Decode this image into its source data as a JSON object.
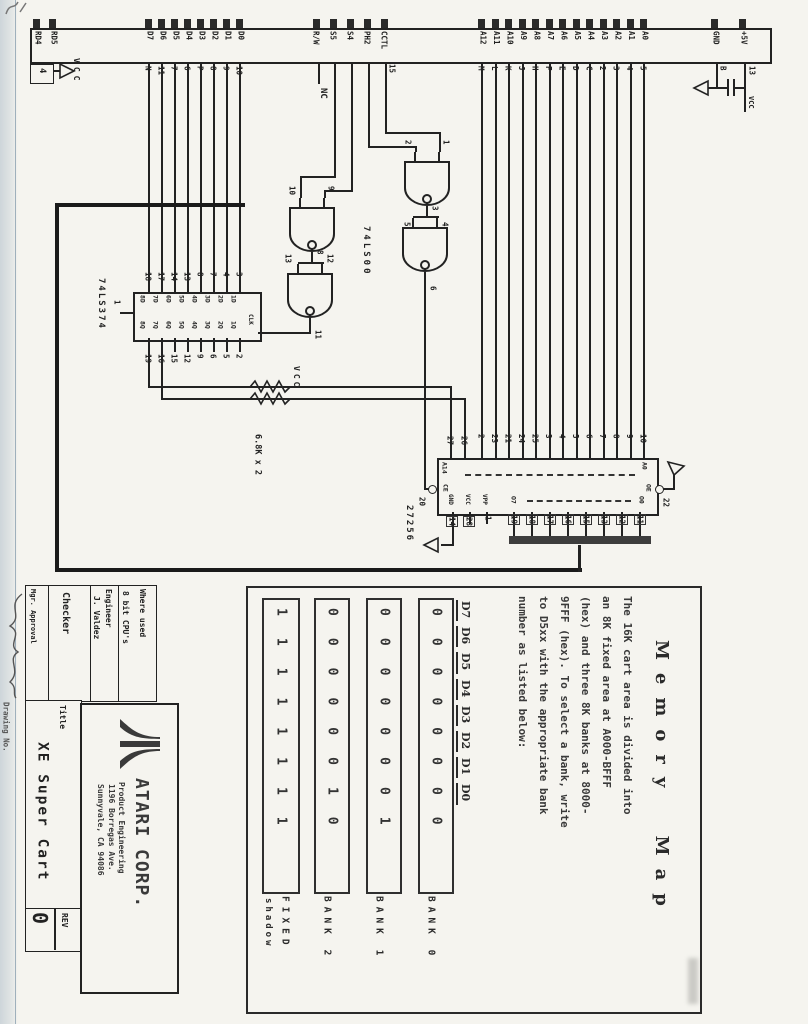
{
  "connector": {
    "rd_pins": [
      "RD4",
      "RD5"
    ],
    "data_pins": [
      "D7",
      "D6",
      "D5",
      "D4",
      "D3",
      "D2",
      "D1",
      "D0"
    ],
    "data_wire_pins": [
      "N",
      "11",
      "7",
      "6",
      "P",
      "8",
      "9",
      "10"
    ],
    "ctl_pins": [
      "R/W",
      "S5",
      "S4",
      "PH2",
      "CCTL"
    ],
    "cctl_wire_pin": "15",
    "nc_label": "NC",
    "addr_pins": [
      "A12",
      "A11",
      "A10",
      "A9",
      "A8",
      "A7",
      "A6",
      "A5",
      "A4",
      "A3",
      "A2",
      "A1",
      "A0"
    ],
    "addr_wire_pins": [
      "M",
      "L",
      "K",
      "J",
      "H",
      "F",
      "E",
      "D",
      "C",
      "2",
      "3",
      "4",
      "5"
    ],
    "pwr_pins": [
      "GND",
      "+5V"
    ],
    "gnd_wire_pin": "B",
    "p5v_wire_pin": "13",
    "left_pin_label": "4",
    "vcc_left": "VCC",
    "vcc_right": "VCC"
  },
  "latch": {
    "part": "74LS374",
    "in_pin_numbers": [
      "18",
      "17",
      "14",
      "13",
      "8",
      "7",
      "4",
      "3"
    ],
    "d_labels": [
      "8D",
      "7D",
      "6D",
      "5D",
      "4D",
      "3D",
      "2D",
      "1D"
    ],
    "q_labels": [
      "8Q",
      "7Q",
      "6Q",
      "5Q",
      "4Q",
      "3Q",
      "2Q",
      "1Q"
    ],
    "out_pin_numbers": [
      "19",
      "16",
      "15",
      "12",
      "9",
      "6",
      "5",
      "2"
    ],
    "oc_pin": "1",
    "clk_label": "CLK",
    "clk_pin": "11"
  },
  "gates": {
    "part": "74LS00",
    "g1_in_a": "10",
    "g1_in_b": "9",
    "g1_out": "8",
    "g2_in_a": "13",
    "g2_in_b": "12",
    "g2_out": "11",
    "g3_in_a": "2",
    "g3_in_b": "1",
    "g3_out": "3",
    "g4_in_a": "5",
    "g4_in_b": "4",
    "g4_out": "6"
  },
  "pullups": {
    "value": "6.8K x 2",
    "vcc": "VCC"
  },
  "rom": {
    "part": "27256",
    "bank_pin_numbers": [
      "27",
      "26"
    ],
    "addr_pin_numbers": [
      "2",
      "23",
      "21",
      "24",
      "25",
      "3",
      "4",
      "5",
      "6",
      "7",
      "8",
      "9",
      "10"
    ],
    "addr_hi": "A14",
    "addr_lo": "A0",
    "ce_label": "CE",
    "ce_pin": "20",
    "oe_label": "OE",
    "oe_pin": "22",
    "gnd_label": "GND",
    "gnd_pin": "14",
    "vcc_label": "VCC",
    "vcc_pin": "28",
    "vpp_label": "VPP",
    "vpp_pin": "1",
    "data_hi": "O7",
    "data_lo": "O0",
    "data_pin_numbers": [
      "19",
      "18",
      "17",
      "16",
      "15",
      "13",
      "12",
      "11"
    ]
  },
  "memory_map": {
    "title": "Memory Map",
    "body_lines": [
      "The 16K cart area is divided into",
      "an 8K fixed area at A000-BFFF",
      "(hex) and three 8K banks at 8000-",
      "9FFF (hex).  To select a bank, write",
      "to D5xx with  the appropriate bank",
      "number as listed below:"
    ],
    "table": {
      "bit_headers": [
        "D7",
        "D6",
        "D5",
        "D4",
        "D3",
        "D2",
        "D1",
        "D0"
      ],
      "rows": [
        {
          "label": "BANK 0",
          "bits": "00000000"
        },
        {
          "label": "BANK 1",
          "bits": "00000001"
        },
        {
          "label": "BANK 2",
          "bits": "00000010"
        },
        {
          "label": "FIXED",
          "sublabel": "shadow",
          "bits": "11111111"
        }
      ]
    }
  },
  "title_block": {
    "where_used_label": "Where used",
    "where_used_value": "8 bit CPU's",
    "engineer_label": "Engineer",
    "engineer_value": "J. Valdez",
    "checker_label": "Checker",
    "mgr_label": "Mgr. Approval",
    "drawing_no_label": "Drawing No.",
    "title_label": "Title",
    "title_value": "XE Super Cart",
    "rev_label": "REV",
    "rev_value": "0",
    "company": "ATARI CORP.",
    "dept": "Product Engineering",
    "address1": "1196 Borregas Ave.",
    "address2": "Sunnyvale, CA 94086"
  }
}
